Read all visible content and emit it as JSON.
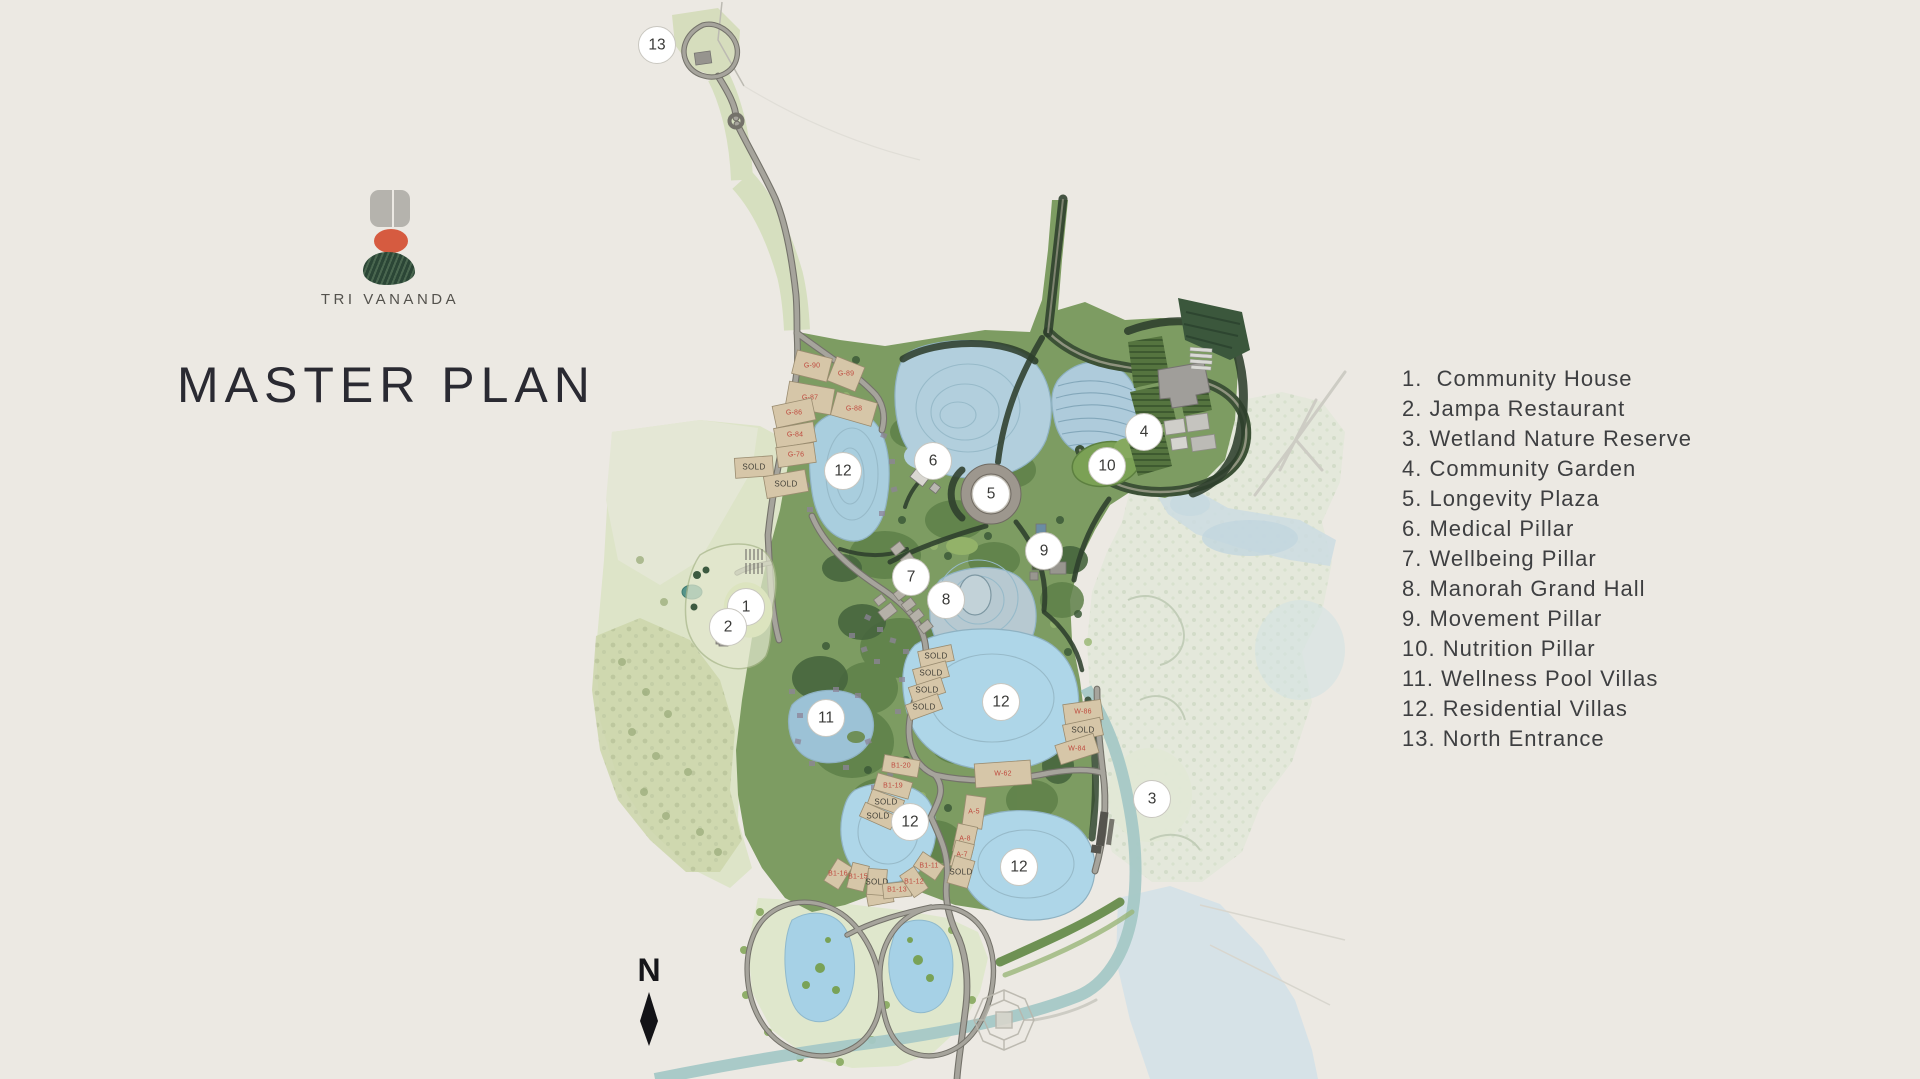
{
  "branding": {
    "logo_text": "TRI VANANDA",
    "title": "MASTER PLAN"
  },
  "legend": {
    "items": [
      "1.  Community House",
      "2. Jampa Restaurant",
      "3. Wetland Nature Reserve",
      "4. Community Garden",
      "5. Longevity Plaza",
      "6. Medical Pillar",
      "7. Wellbeing Pillar",
      "8. Manorah Grand Hall",
      "9. Movement Pillar",
      "10. Nutrition Pillar",
      "11. Wellness Pool Villas",
      "12. Residential Villas",
      "13. North Entrance"
    ]
  },
  "compass": {
    "north_label": "N"
  },
  "map": {
    "marker_labels": [
      "1",
      "2",
      "3",
      "4",
      "5",
      "6",
      "7",
      "8",
      "9",
      "10",
      "11",
      "12",
      "12",
      "12",
      "12",
      "13"
    ],
    "plot_labels": [
      "G-90",
      "G-89",
      "G-87",
      "G-88",
      "G-86",
      "G-84",
      "G-76",
      "SOLD",
      "SOLD",
      "SOLD",
      "SOLD",
      "SOLD",
      "SOLD",
      "W-86",
      "SOLD",
      "W-84",
      "W-62",
      "B1-20",
      "B1-19",
      "SOLD",
      "SOLD",
      "A-5",
      "A-8",
      "A-7",
      "SOLD",
      "B1-16",
      "B1-15",
      "SOLD",
      "B1-13",
      "B1-12",
      "B1-11"
    ],
    "colors": {
      "background": "#ece9e3",
      "logo_gray": "#b5b3ad",
      "logo_red": "#d65b40",
      "logo_green": "#2b4636",
      "title_text": "#2a2a32",
      "legend_text": "#3e3f41",
      "vegetation": "#7d9c62",
      "open_land": "#dde4c8",
      "lake": "#aed2e4",
      "plot_fill": "#d6c6a8",
      "plot_label_red": "#bf4a3e",
      "road": "#a6a49c",
      "marker_fill": "#ffffff"
    }
  }
}
